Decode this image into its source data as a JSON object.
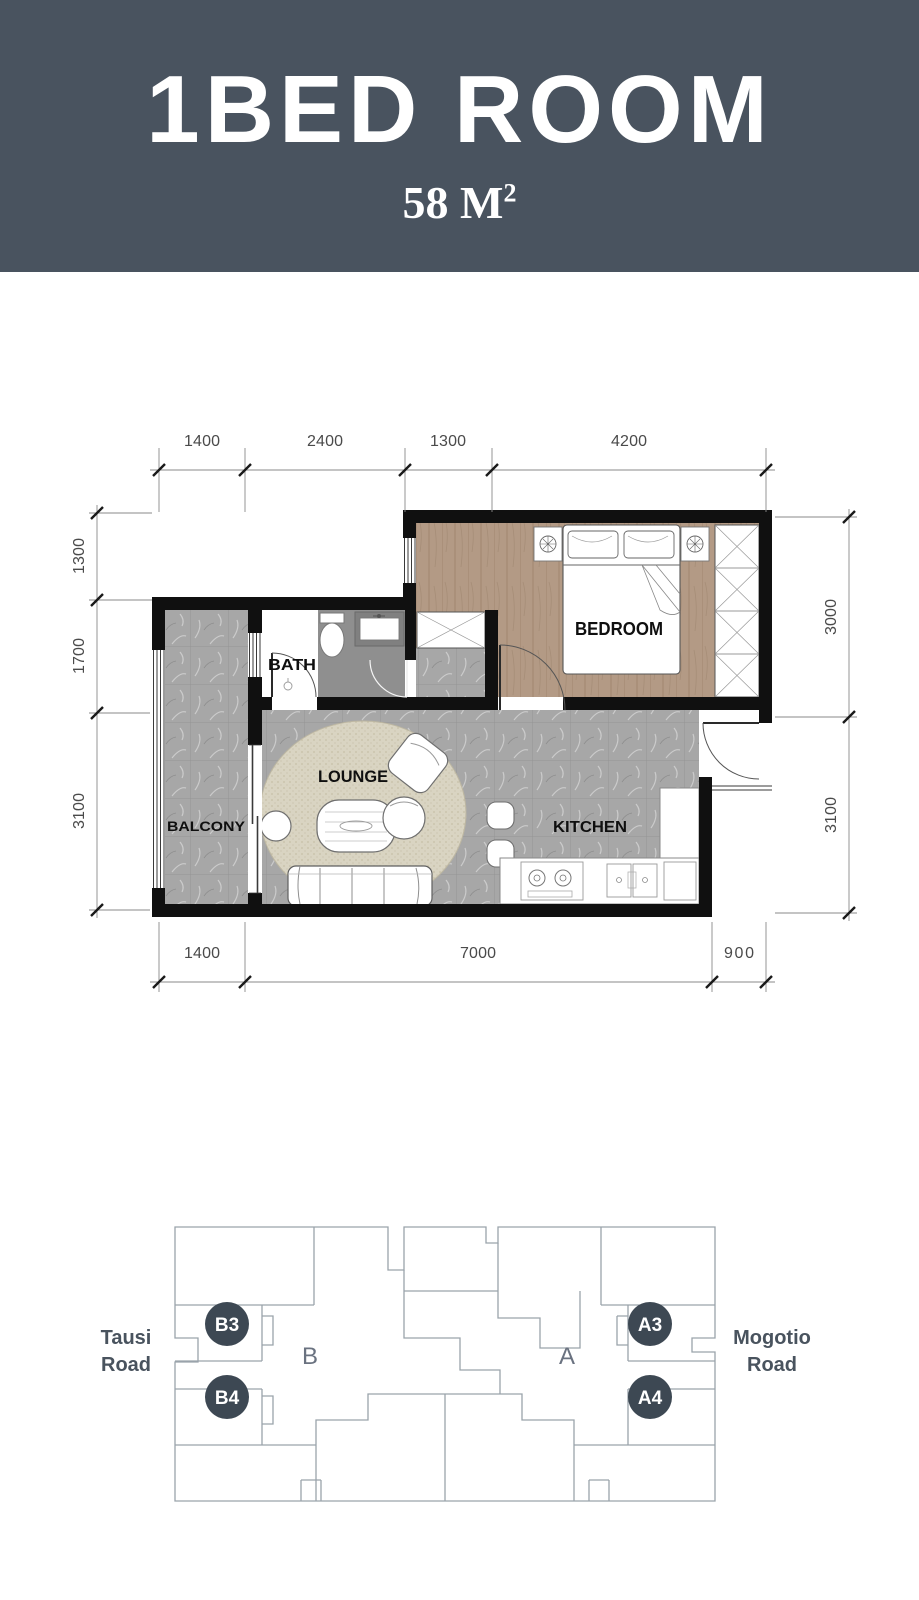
{
  "header": {
    "title": "1BED ROOM",
    "area_value": "58 M",
    "area_superscript": "2"
  },
  "colors": {
    "header_bg": "#49535f",
    "wall": "#101010",
    "unit_badge": "#3d4853",
    "site_outline": "#9aa3ab",
    "marble_floor": "#a7a7a7",
    "wood_floor": "#b39a85",
    "rug": "#d9d4c2"
  },
  "plan": {
    "rooms": [
      {
        "name": "BEDROOM"
      },
      {
        "name": "BATH"
      },
      {
        "name": "LOUNGE"
      },
      {
        "name": "BALCONY"
      },
      {
        "name": "KITCHEN"
      }
    ],
    "dimensions": {
      "top": [
        "1400",
        "2400",
        "1300",
        "4200"
      ],
      "left": [
        "1300",
        "1700",
        "3100"
      ],
      "right": [
        "3000",
        "3100"
      ],
      "bottom": [
        "1400",
        "7000",
        "900"
      ]
    }
  },
  "site_plan": {
    "roads": [
      {
        "line1": "Tausi",
        "line2": "Road"
      },
      {
        "line1": "Mogotio",
        "line2": "Road"
      }
    ],
    "blocks": [
      {
        "label": "B"
      },
      {
        "label": "A"
      }
    ],
    "units": [
      {
        "label": "B3"
      },
      {
        "label": "B4"
      },
      {
        "label": "A3"
      },
      {
        "label": "A4"
      }
    ]
  }
}
